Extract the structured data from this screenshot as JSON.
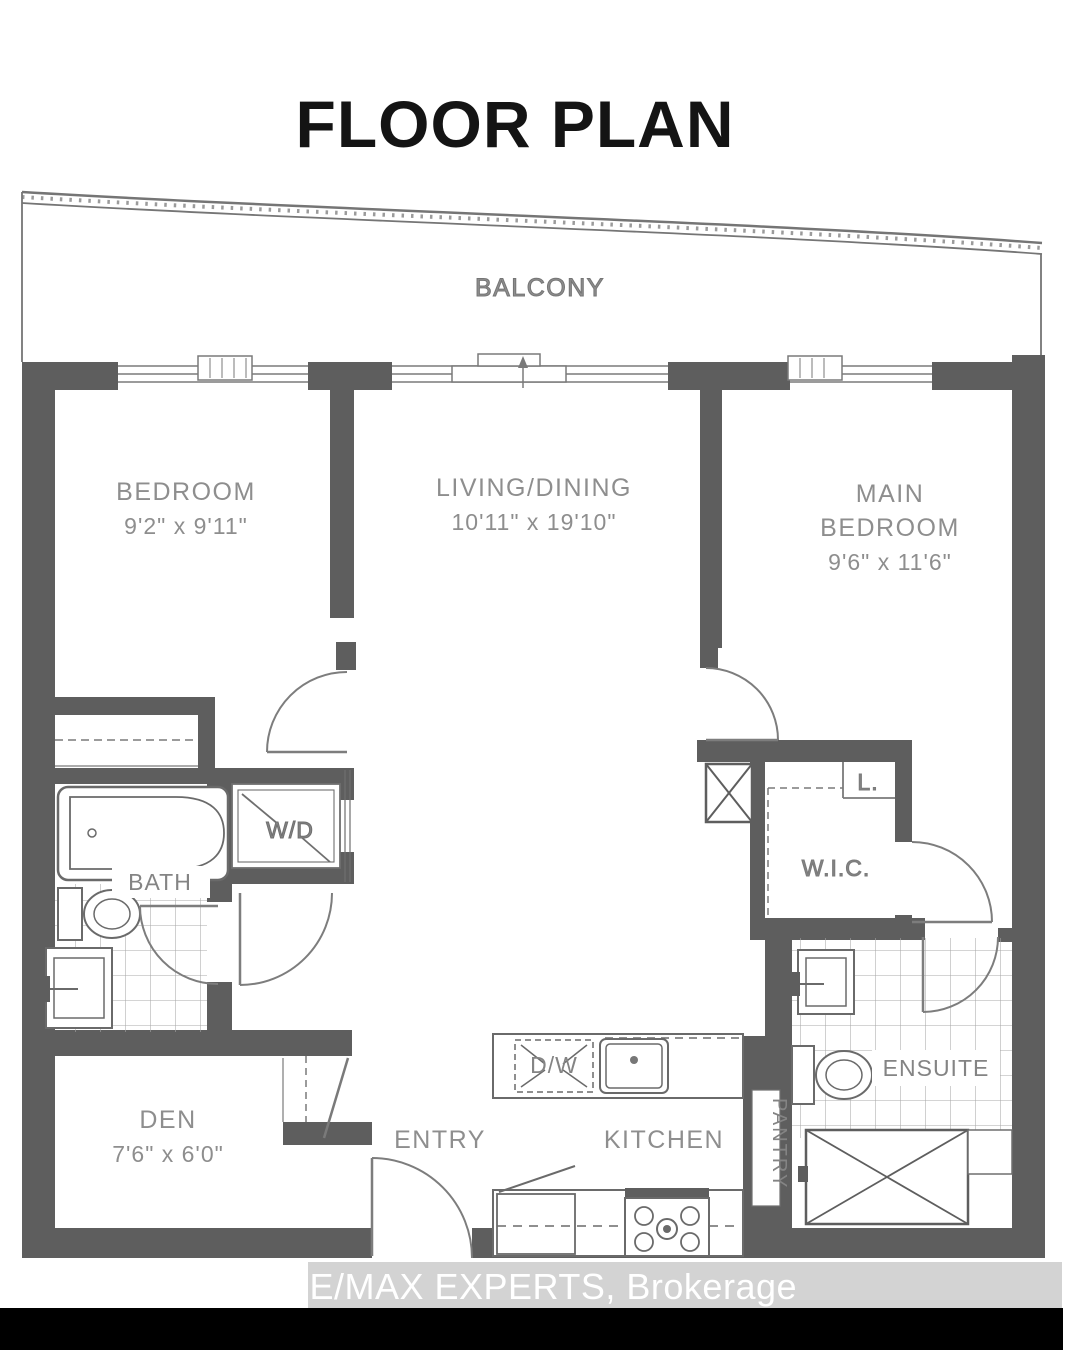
{
  "title": "FLOOR PLAN",
  "watermark": "RE/MAX EXPERTS, Brokerage",
  "colors": {
    "wall": "#5e5e5e",
    "thin_line": "#757575",
    "door_arc": "#7d7d7d",
    "label": "#8e8e8e",
    "tile_line": "#a8a8a8",
    "title_text": "#141414",
    "watermark_bg": "#d3d3d3",
    "watermark_text": "#ffffff",
    "footer_bar": "#000000",
    "background": "#ffffff"
  },
  "rooms": {
    "balcony": {
      "label": "BALCONY"
    },
    "bedroom": {
      "label": "BEDROOM",
      "dims": "9'2\" x 9'11\""
    },
    "living": {
      "label": "LIVING/DINING",
      "dims": "10'11\" x 19'10\""
    },
    "main_bedroom": {
      "label_line1": "MAIN",
      "label_line2": "BEDROOM",
      "dims": "9'6\" x 11'6\""
    },
    "bath": {
      "label": "BATH"
    },
    "wd": {
      "label": "W/D"
    },
    "wic": {
      "label": "W.I.C."
    },
    "linen": {
      "label": "L."
    },
    "ensuite": {
      "label": "ENSUITE"
    },
    "den": {
      "label": "DEN",
      "dims": "7'6\" x 6'0\""
    },
    "entry": {
      "label": "ENTRY"
    },
    "kitchen": {
      "label": "KITCHEN"
    },
    "pantry": {
      "label": "PANTRY"
    },
    "dw": {
      "label": "D/W"
    }
  }
}
